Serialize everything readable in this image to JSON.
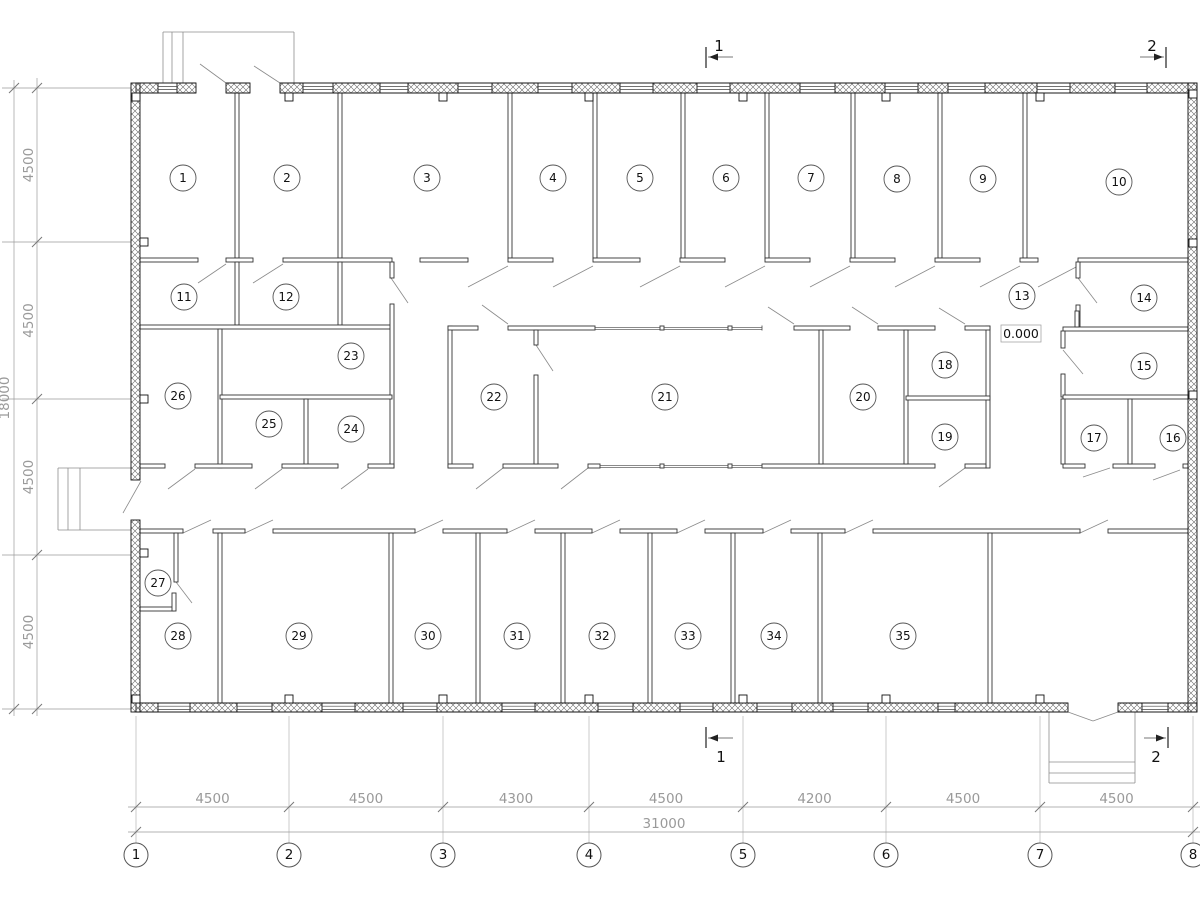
{
  "plan": {
    "rooms": [
      "1",
      "2",
      "3",
      "4",
      "5",
      "6",
      "7",
      "8",
      "9",
      "10",
      "11",
      "12",
      "13",
      "14",
      "15",
      "16",
      "17",
      "18",
      "19",
      "20",
      "21",
      "22",
      "23",
      "24",
      "25",
      "26",
      "27",
      "28",
      "29",
      "30",
      "31",
      "32",
      "33",
      "34",
      "35"
    ],
    "axes_bottom": [
      "1",
      "2",
      "3",
      "4",
      "5",
      "6",
      "7",
      "8"
    ],
    "dims_bottom": [
      "4500",
      "4500",
      "4300",
      "4500",
      "4200",
      "4500",
      "4500"
    ],
    "dim_total_bottom": "31000",
    "dims_left": [
      "4500",
      "4500",
      "4500",
      "4500"
    ],
    "dim_total_left": "18000",
    "elevation": "0.000",
    "sections": {
      "top": [
        "1",
        "2"
      ],
      "bottom": [
        "1",
        "2"
      ]
    },
    "colors": {
      "line": "#1a1a1a",
      "thin": "#444444",
      "aux": "#9a9a9a",
      "swing": "#8a8a8a",
      "text_dim": "#9a9a9a",
      "text_main": "#111111"
    }
  }
}
